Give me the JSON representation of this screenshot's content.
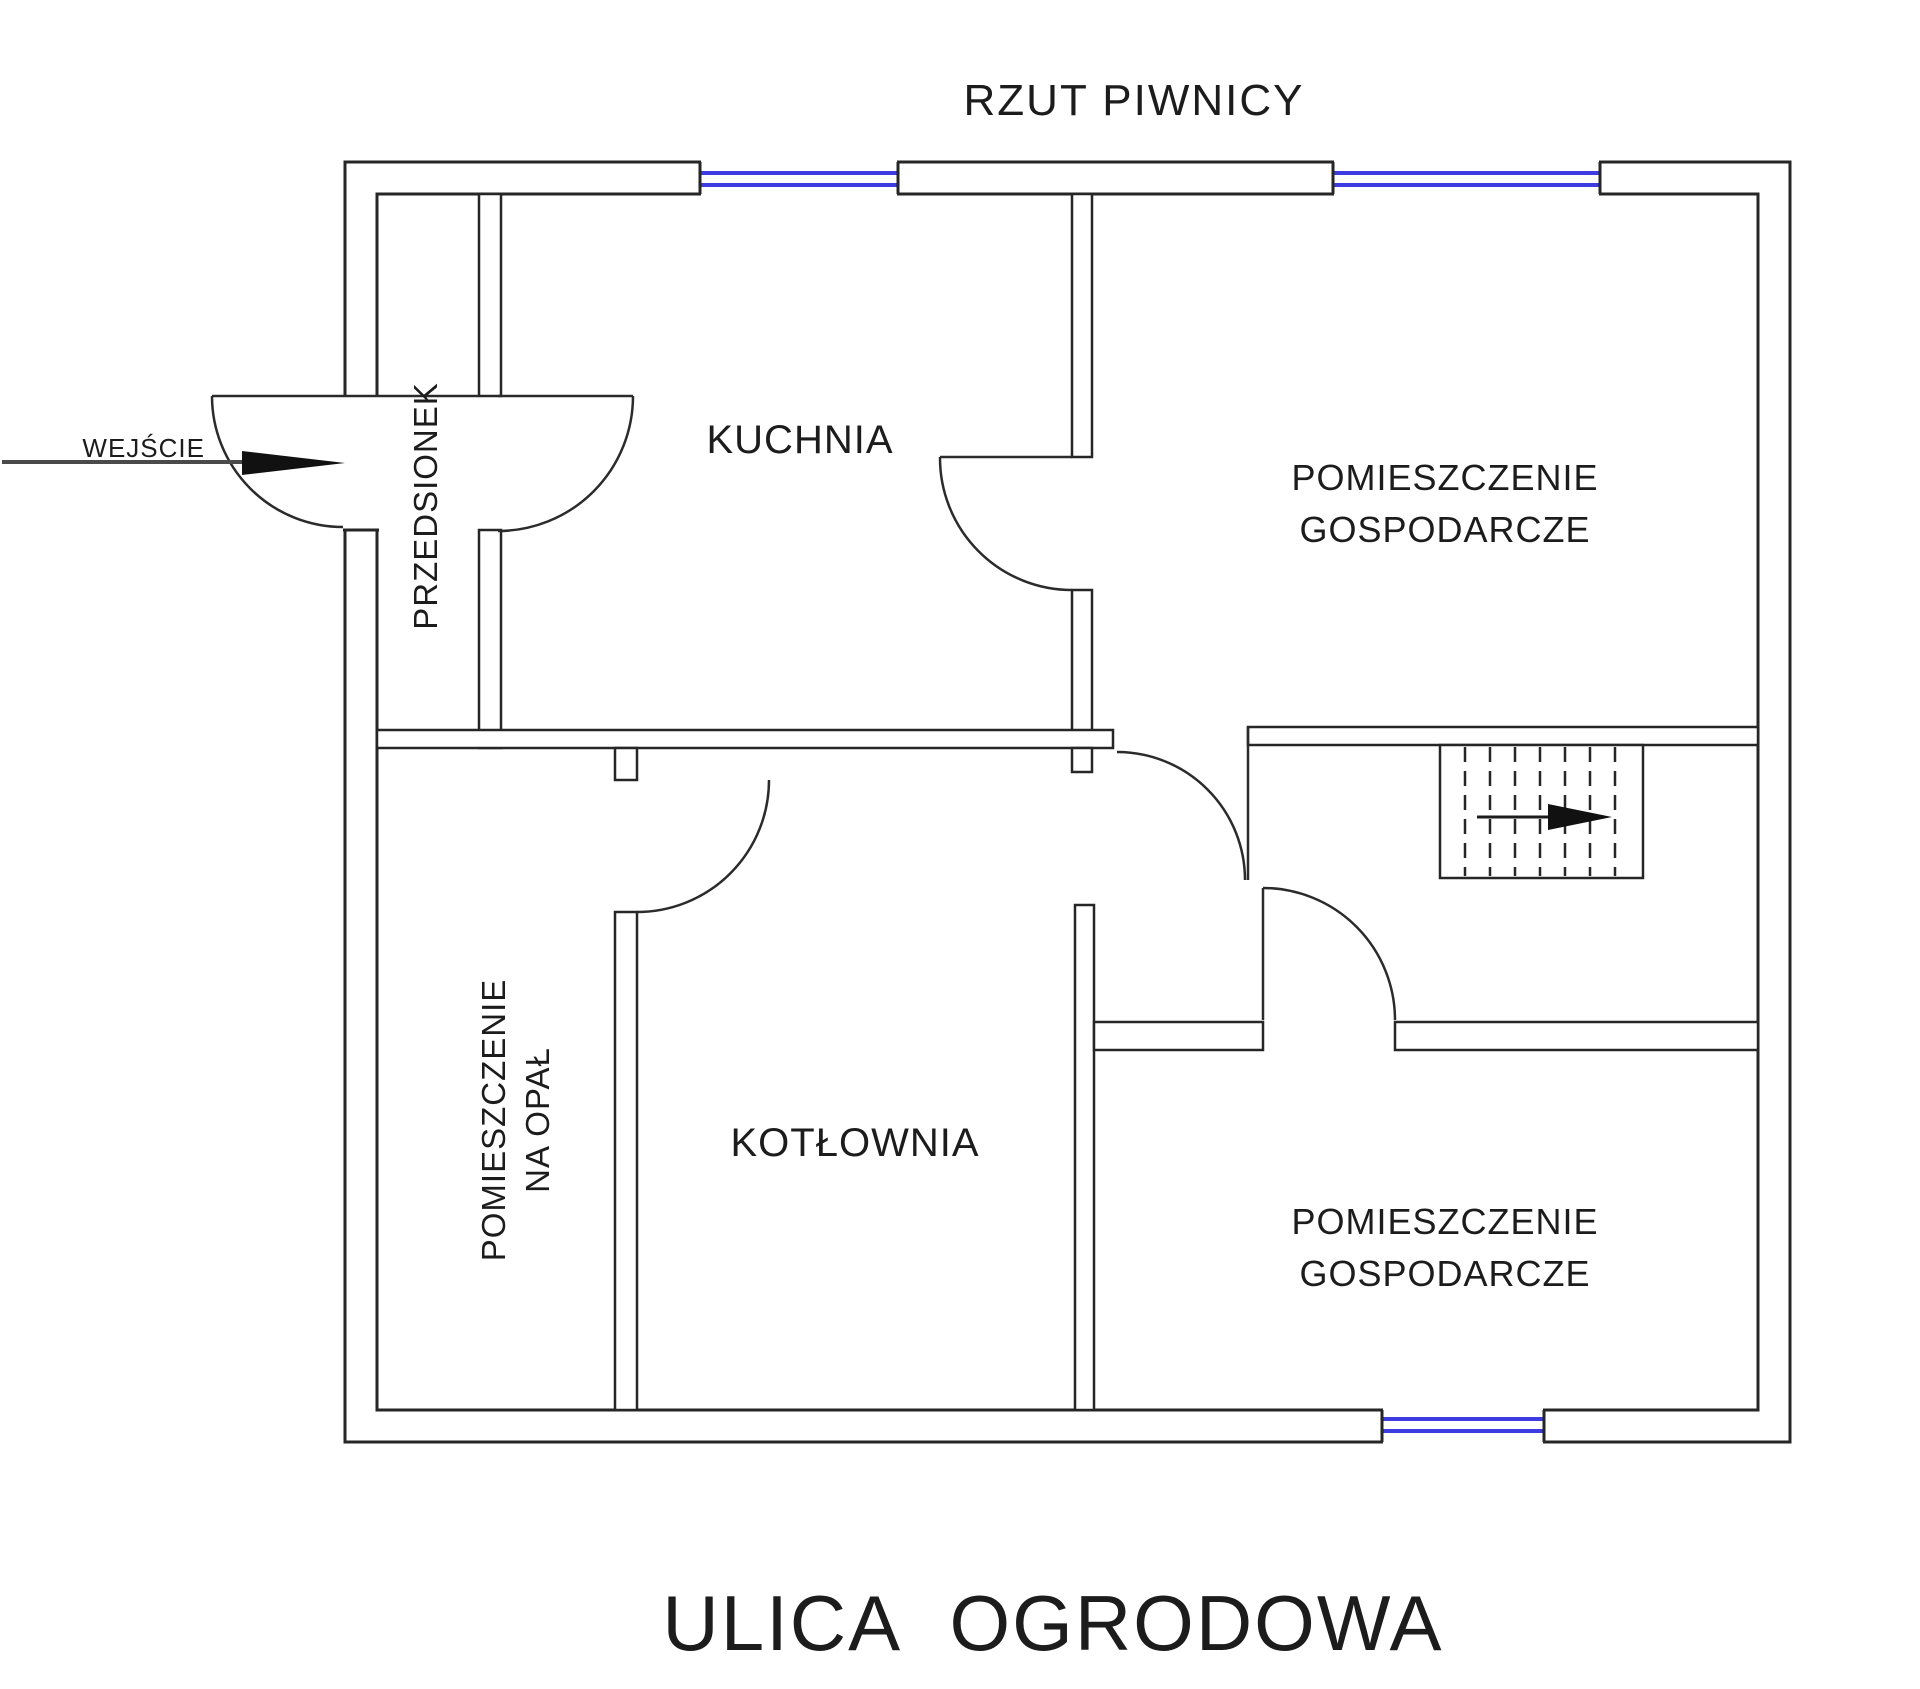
{
  "title": "RZUT PIWNICY",
  "street": "ULICA OGRODOWA",
  "annotations": {
    "entrance": "WEJŚCIE"
  },
  "rooms": {
    "przedsionek": "PRZEDSIONEK",
    "kuchnia": "KUCHNIA",
    "gospodarcze_top": {
      "line1": "POMIESZCZENIE",
      "line2": "GOSPODARCZE"
    },
    "na_opal": {
      "line1": "POMIESZCZENIE",
      "line2": "NA OPAŁ"
    },
    "kotlownia": "KOTŁOWNIA",
    "gospodarcze_bottom": {
      "line1": "POMIESZCZENIE",
      "line2": "GOSPODARCZE"
    }
  },
  "symbols": {
    "stairs": "stairs-up-arrow-right",
    "entrance_arrow": "arrow-right",
    "window": "double-blue-line"
  },
  "colors": {
    "wall": "#262626",
    "door": "#2b2b2b",
    "window": "#3c3ce0",
    "path": "#4a4a4a",
    "text": "#1c1c1c",
    "background": "#ffffff"
  }
}
